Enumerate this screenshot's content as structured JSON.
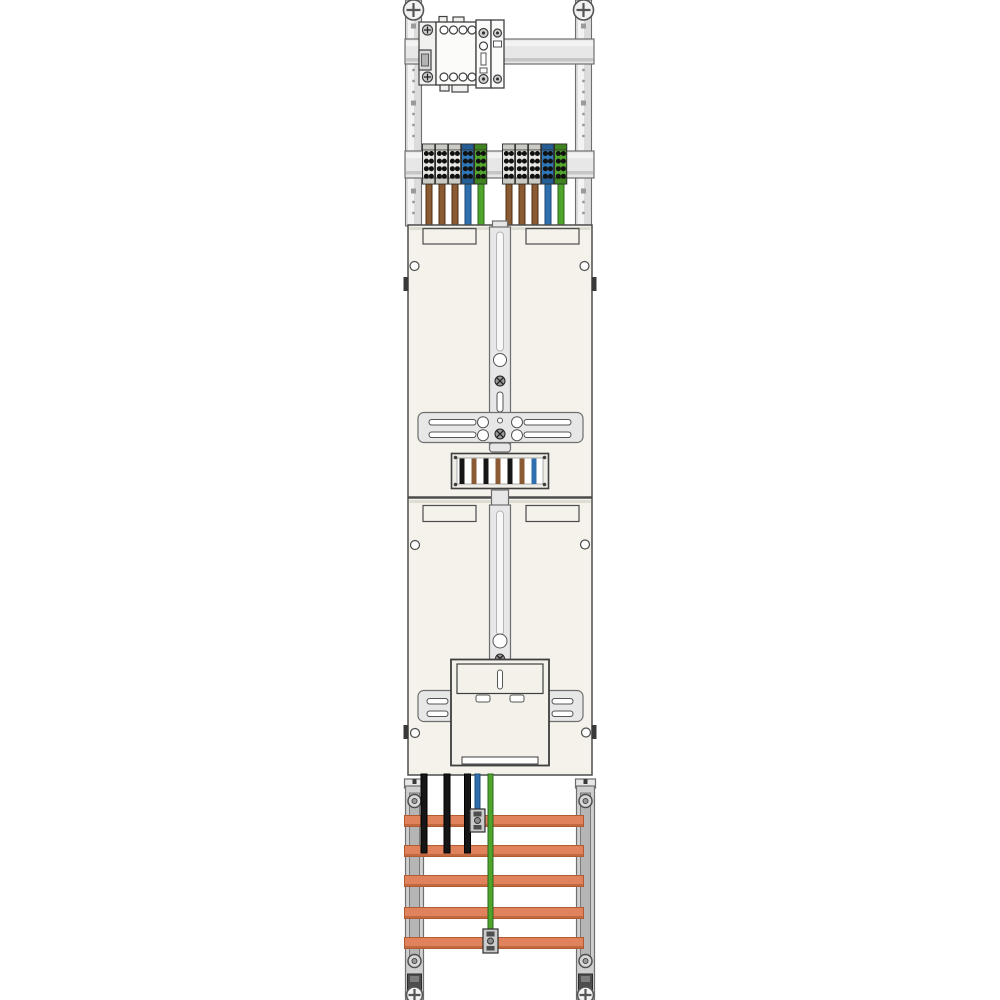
{
  "image_alt": "Technical illustration of a tall two-position electricity meter mounting panel: top hat-rail with a multi-pole switching device, two groups of five feed terminals (grey, blue, green) with brown, blue and green wires, two cream meter mounting plates with three-point fixing crossbars, a wire pass-through window, a lower meter cover box, and a bottom busbar field with five copper bars, three black phase wires, one blue neutral wire and one green earth wire fixed by screw clamps on vertical rails.",
  "colors": {
    "background": "#ffffff",
    "panel": "#f4f2ea",
    "panel_border": "#4d4d4d",
    "metal_light": "#f3f3f3",
    "metal": "#e7e7e7",
    "metal_mid": "#dcdcdc",
    "metal_dark": "#9a9a9a",
    "outline": "#6e6e6e",
    "device_body": "#fbfbfa",
    "device_outline": "#3f3f3f",
    "busbar": "#e0835c",
    "busbar_edge": "#b25a31",
    "rail_gray": "#cfcfcf",
    "terminal_gray": "#e6e5e1",
    "terminal_gray_cap": "#cbcac5",
    "terminal_blue": "#3077b7",
    "terminal_blue_cap": "#255e94",
    "terminal_green": "#52a52d",
    "terminal_green_cap": "#3f8420",
    "wire_brown": "#8a5a33",
    "wire_brown_edge": "#4f2f12",
    "wire_black": "#161616",
    "wire_black_edge": "#000000",
    "wire_blue": "#2f6fad",
    "wire_blue_edge": "#1c4a78",
    "wire_green": "#4fa42c",
    "wire_green_edge": "#2c661a"
  },
  "top_rails": {
    "x_centers": [
      413.5,
      583.5
    ],
    "y_top": 0,
    "y_bottom": 226
  },
  "terminals": {
    "groups": [
      {
        "x": 422.5
      },
      {
        "x": 502.5
      }
    ],
    "block_pattern": [
      "gray",
      "gray",
      "gray",
      "blue",
      "green"
    ],
    "wire_pattern": [
      "brown",
      "brown",
      "brown",
      "blue",
      "green"
    ],
    "block_width": 13,
    "block_y": 144,
    "block_h": 40,
    "wire_y1": 184,
    "wire_y2": 227
  },
  "wire_window": {
    "wires": [
      "black",
      "brown",
      "black",
      "brown",
      "black",
      "brown",
      "blue"
    ],
    "x_start": 459.5,
    "spacing": 12,
    "wire_width": 5,
    "y": 458.5,
    "h": 25.5
  },
  "busbars": {
    "count": 5,
    "y_tops": [
      815.5,
      845.5,
      875.5,
      907.5,
      937.5
    ],
    "x": 404.5,
    "width": 179,
    "height": 11
  },
  "bottom_wires": [
    {
      "name": "phase-wire-1",
      "x": 424,
      "color": "black",
      "width": 6,
      "y_start": 774,
      "y_end": 853
    },
    {
      "name": "phase-wire-2",
      "x": 447,
      "color": "black",
      "width": 6,
      "y_start": 774,
      "y_end": 853
    },
    {
      "name": "phase-wire-3",
      "x": 467.5,
      "color": "black",
      "width": 6,
      "y_start": 774,
      "y_end": 853
    },
    {
      "name": "neutral-wire",
      "x": 477.5,
      "color": "blue",
      "width": 5,
      "y_start": 774,
      "y_end": 818
    },
    {
      "name": "earth-wire",
      "x": 490.5,
      "color": "green",
      "width": 5,
      "y_start": 774,
      "y_end": 948
    }
  ],
  "wire_clamps": [
    {
      "name": "neutral-busbar-clamp",
      "x": 477.5,
      "y": 809,
      "h": 23
    },
    {
      "name": "earth-busbar-clamp",
      "x": 490.5,
      "y": 929,
      "h": 24
    }
  ]
}
